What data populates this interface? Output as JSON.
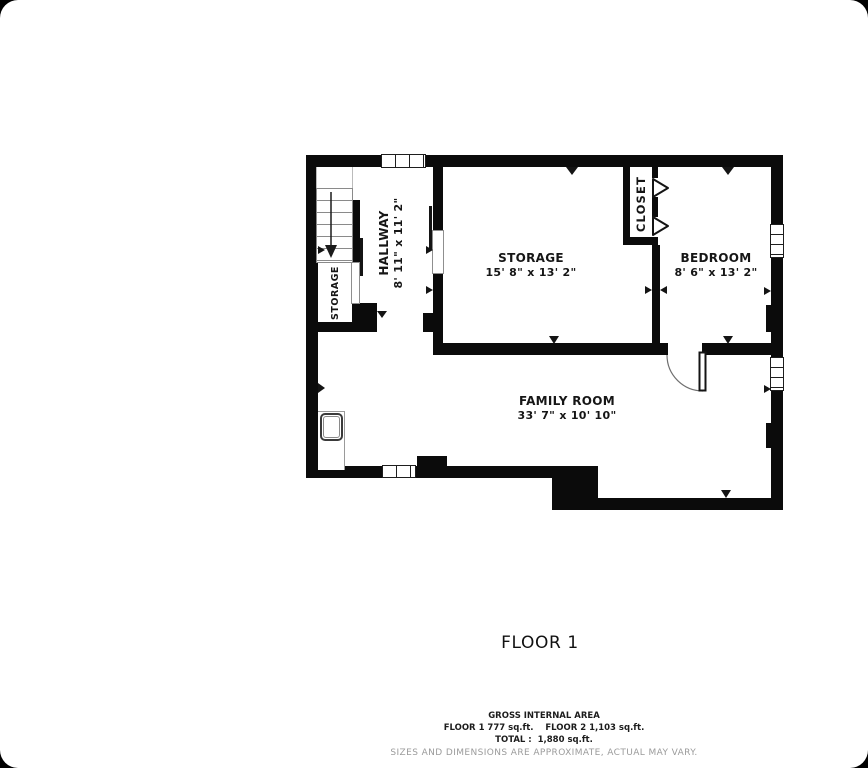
{
  "floor_plan": {
    "title": "FLOOR 1",
    "rooms": {
      "hallway": {
        "label": "HALLWAY",
        "dims": "8' 11\" x 11' 2\""
      },
      "storage": {
        "label": "STORAGE",
        "dims": "15' 8\" x 13' 2\""
      },
      "bedroom": {
        "label": "BEDROOM",
        "dims": "8' 6\" x 13' 2\""
      },
      "family_room": {
        "label": "FAMILY ROOM",
        "dims": "33' 7\" x 10' 10\""
      },
      "closet": {
        "label": "CLOSET"
      },
      "understairs_storage": {
        "label": "STORAGE"
      }
    },
    "footer": {
      "gross_area_title": "GROSS INTERNAL AREA",
      "floor_areas": "FLOOR 1 777 sq.ft.    FLOOR 2 1,103 sq.ft.",
      "total": "TOTAL :  1,880 sq.ft.",
      "disclaimer": "SIZES AND DIMENSIONS ARE APPROXIMATE, ACTUAL MAY VARY."
    },
    "colors": {
      "wall": "#0b0b0b",
      "text": "#161616",
      "disclaimer_text": "#9b9b9b"
    }
  }
}
